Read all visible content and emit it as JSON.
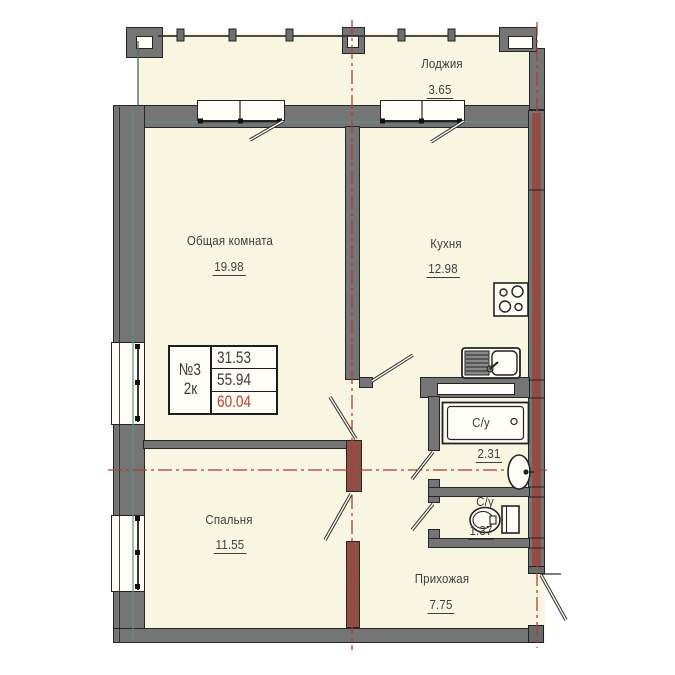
{
  "title": "Apartment floor plan 2k",
  "rooms": [
    {
      "name": "Лоджия",
      "area": "3.65"
    },
    {
      "name": "Общая комната",
      "area": "19.98"
    },
    {
      "name": "Кухня",
      "area": "12.98"
    },
    {
      "name": "Спальня",
      "area": "11.55"
    },
    {
      "name": "Прихожая",
      "area": "7.75"
    },
    {
      "name": "С/у",
      "area": "2.31"
    },
    {
      "name": "С/у",
      "area": "1.37"
    }
  ],
  "info_box": {
    "number": "№3",
    "type": "2к",
    "values": [
      "31.53",
      "55.94",
      "60.04"
    ]
  },
  "icons": [
    "stove-icon",
    "kitchen-sink-icon",
    "bathtub-icon",
    "washbasin-icon",
    "toilet-icon"
  ],
  "colors": {
    "wall": "#757575",
    "brick": "#8f4f47",
    "floor": "#f8f5e1",
    "axis_red": "#b23b30",
    "total_area_red": "#c0392b",
    "line": "#2e2e2e",
    "utility_teal": "#5d8f8f"
  }
}
